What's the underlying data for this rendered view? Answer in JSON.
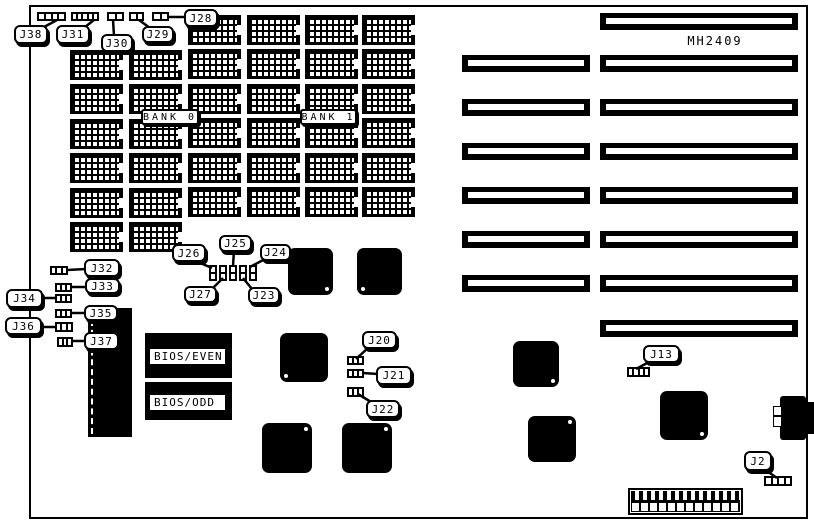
{
  "board": {
    "model": "MH2409"
  },
  "callouts": {
    "j38": "J38",
    "j31": "J31",
    "j30": "J30",
    "j29": "J29",
    "j28": "J28",
    "j32": "J32",
    "j33": "J33",
    "j34": "J34",
    "j35": "J35",
    "j36": "J36",
    "j37": "J37",
    "j26": "J26",
    "j25": "J25",
    "j24": "J24",
    "j27": "J27",
    "j23": "J23",
    "j20": "J20",
    "j21": "J21",
    "j22": "J22",
    "j13": "J13",
    "j2": "J2"
  },
  "memory": {
    "bank0_label": "BANK 0",
    "bank1_label": "BANK 1",
    "chip_count": 36
  },
  "bios": {
    "even": "BIOS/EVEN",
    "odd": "BIOS/ODD"
  },
  "slots": {
    "long_count": 8,
    "short_count": 6
  },
  "colors": {
    "ink": "#000000",
    "paper": "#ffffff"
  }
}
